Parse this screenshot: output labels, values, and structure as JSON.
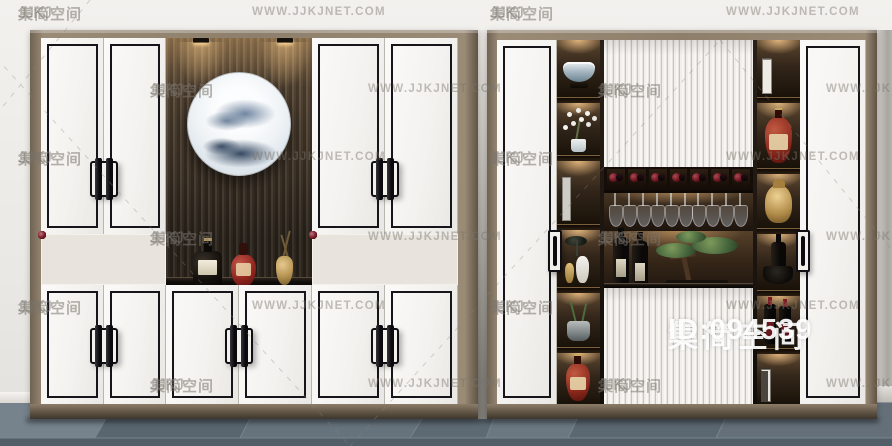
{
  "watermark": {
    "logo_text": "JJKJ 集简空间",
    "logo_latin": "JJKJ",
    "logo_cjk": "集简空间",
    "url_text": "WWW.JJKJNET.COM",
    "badge_title": "集简空间",
    "badge_id": "ID:094539",
    "text_color": "#7a756d",
    "badge_color": "#ffffff"
  },
  "scene": {
    "wall_color": "#eceae6",
    "floor_color": "#5f6b75",
    "frame_color": "#8d7f6b",
    "door_color": "#f4f2ef",
    "counter_color": "#120e0a",
    "wine_red": "#6e1620",
    "brass_color": "#c9a96a"
  },
  "left_cabinet": {
    "name": "wine-display-cabinet-a",
    "upper_doors": 4,
    "lower_doors": 6,
    "wine_rack_left": [
      [
        1,
        1,
        0,
        1,
        1,
        1,
        1
      ],
      [
        1,
        1,
        1,
        1,
        0,
        1,
        1
      ],
      [
        1,
        0,
        1,
        0,
        1,
        0,
        1
      ]
    ],
    "wine_rack_right": [
      [
        1,
        1,
        1,
        1,
        0,
        1,
        1
      ],
      [
        1,
        1,
        0,
        1,
        1,
        1,
        1
      ],
      [
        0,
        1,
        0,
        1,
        0,
        1,
        0
      ]
    ],
    "decor": [
      "ceiling-spotlights",
      "round-ink-landscape-painting",
      "dark-liquor-bottle",
      "red-liquor-bottle",
      "brass-vase-with-branch"
    ]
  },
  "right_cabinet": {
    "name": "wine-display-cabinet-b",
    "doors": 2,
    "cubby_bottles": 7,
    "hanging_glasses": 10,
    "left_shelf_items": [
      "porcelain-bowl",
      "orchid-plant",
      "book-boxes",
      "lotus-decor-and-vases",
      "stone-pot-plant",
      "red-brandy-bottle"
    ],
    "right_shelf_items": [
      "box-files-dark",
      "brandy-bottle",
      "buddha-head",
      "dark-bottle-and-bowl",
      "wine-bottles",
      "box-files-white"
    ],
    "center_items": [
      "fluted-sliding-panels",
      "wine-cubbies",
      "hanging-stemware",
      "standing-wine-bottles",
      "bonsai-pine"
    ]
  }
}
